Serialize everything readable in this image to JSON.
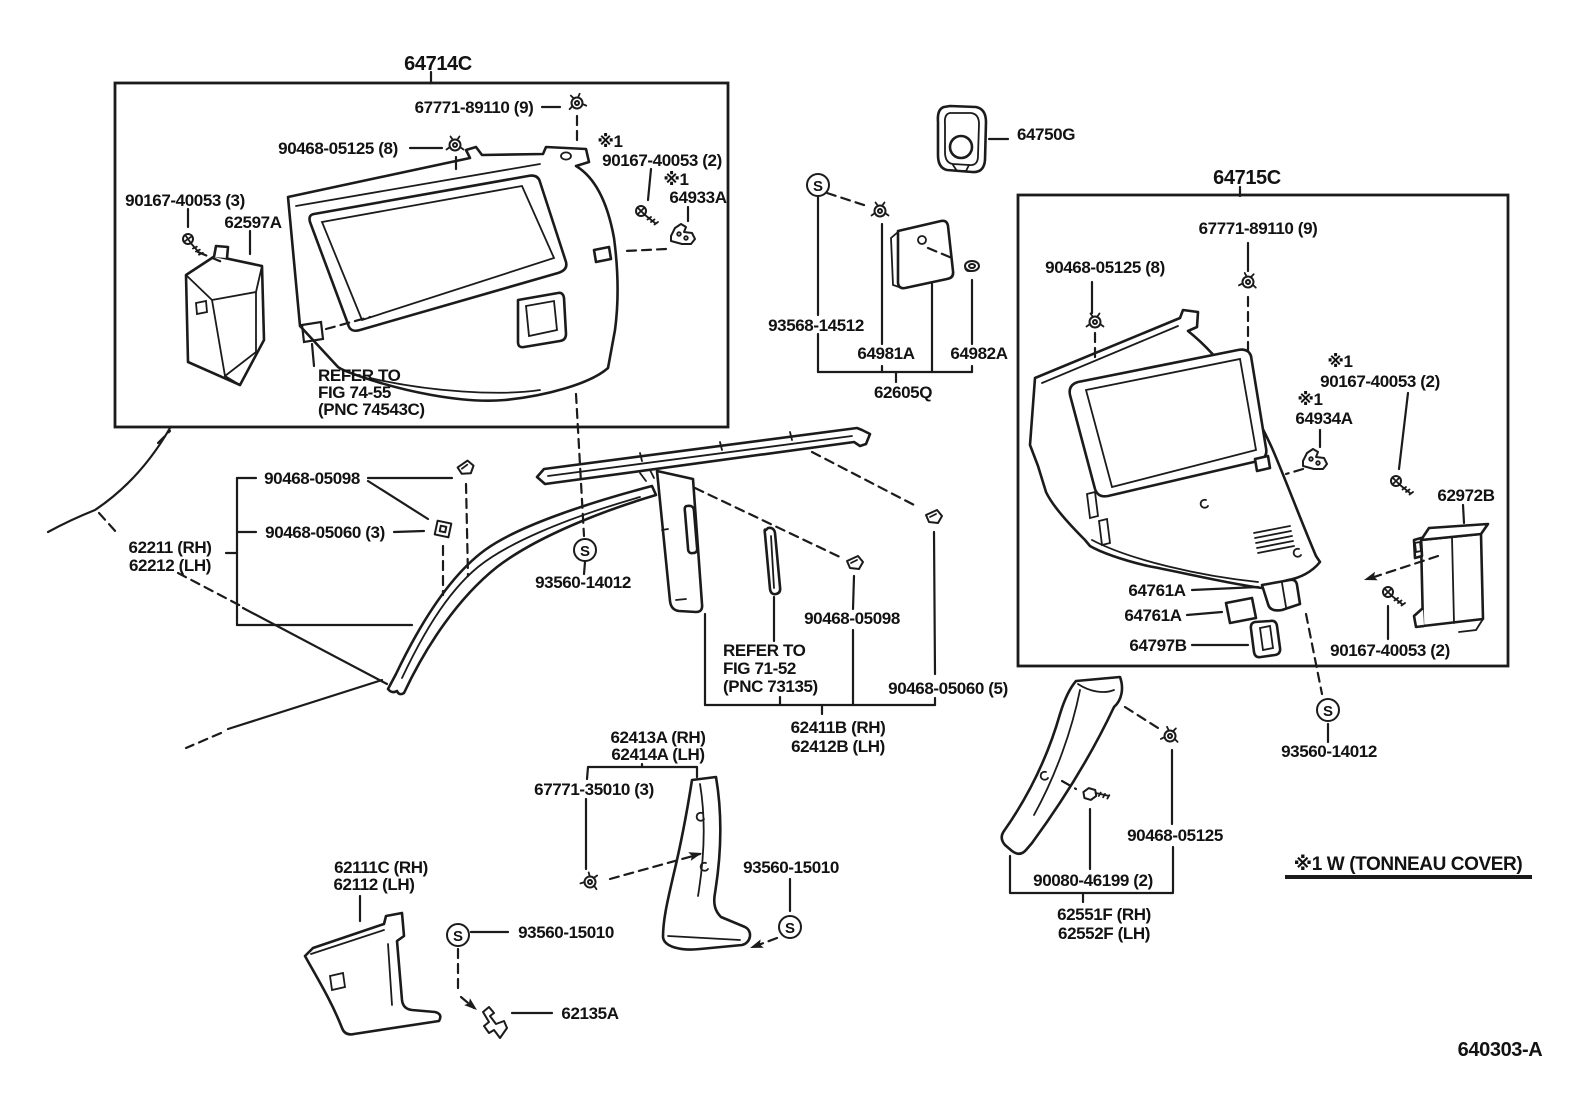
{
  "s_symbol": "S",
  "figure_code": "640303-A",
  "note": "※1 W (TONNEAU COVER)",
  "box_left": {
    "title": "64714C",
    "clip_top": "67771-89110 (9)",
    "clip_side": "90468-05125 (8)",
    "flag1": "※1",
    "screw_right": "90167-40053 (2)",
    "flag2": "※1",
    "bracket": "64933A",
    "screw_left": "90167-40053 (3)",
    "speaker_box": "62597A",
    "refer1": "REFER TO",
    "refer2": "FIG 74-55",
    "refer3": "(PNC 74543C)"
  },
  "escutcheon": {
    "label": "64750G"
  },
  "fuel_group": {
    "screw": "93568-14512",
    "plate": "64981A",
    "grommet": "64982A",
    "assy": "62605Q"
  },
  "box_right": {
    "title": "64715C",
    "clip_top": "67771-89110 (9)",
    "clip_side": "90468-05125 (8)",
    "flag1": "※1",
    "screw_top": "90167-40053 (2)",
    "flag2": "※1",
    "bracket": "64934A",
    "cover": "62972B",
    "flap1": "64761A",
    "flap2": "64761A",
    "bezel": "64797B",
    "screw_bottom": "90167-40053 (2)",
    "screw_fix": "93560-14012"
  },
  "apillar": {
    "part_rh": "62211 (RH)",
    "part_lh": "62212 (LH)",
    "clip1": "90468-05098",
    "clip2": "90468-05060 (3)",
    "screw_fix": "93560-14012"
  },
  "bpillar_upper": {
    "clip1": "90468-05098",
    "clip2": "90468-05060 (5)",
    "refer1": "REFER TO",
    "refer2": "FIG 71-52",
    "refer3": "(PNC 73135)",
    "part_rh": "62411B (RH)",
    "part_lh": "62412B (LH)"
  },
  "bpillar_lower": {
    "part_rh": "62413A (RH)",
    "part_lh": "62414A (LH)",
    "clip": "67771-35010 (3)",
    "screw_fix_right": "93560-15010",
    "screw_fix_left": "93560-15010",
    "hook": "62135A"
  },
  "cowl": {
    "part_rh": "62111C (RH)",
    "part_lh": "62112  (LH)"
  },
  "quarter_pillar": {
    "clip": "90468-05125",
    "bolt": "90080-46199 (2)",
    "part_rh": "62551F (RH)",
    "part_lh": "62552F (LH)"
  }
}
